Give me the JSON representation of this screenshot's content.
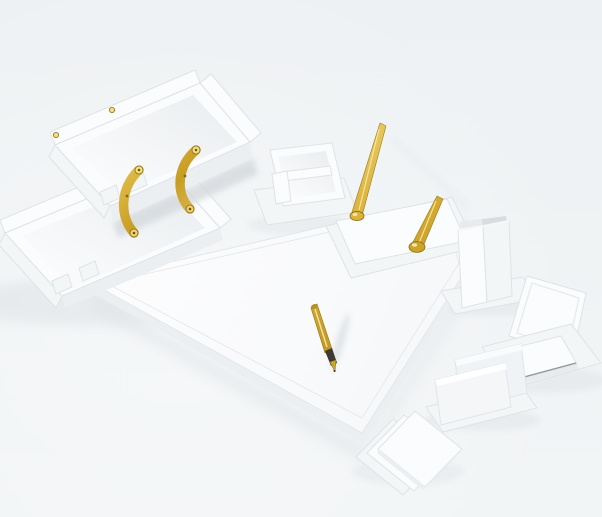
{
  "scene": {
    "type": "product-photograph",
    "subject": "White leather desk organizer set with gold accents arranged on a pale grey-blue studio background",
    "background": "soft light grey-blue studio sweep, brighter toward lower left",
    "palette": {
      "bg_top": "#edf1f3",
      "bg_bottom": "#f2f5f6",
      "white": "#fbfcfd",
      "white_dim": "#f3f6f7",
      "white_shadow": "#eceff1",
      "edge": "#dfe3e6",
      "interior": "#e9edef",
      "gap_shadow": "#d4d9dd",
      "shadow_tint": "#c7ced4",
      "cup_inner": "#d8dcdf",
      "gold_light": "#f3df87",
      "gold": "#d9ad31",
      "gold_dark": "#a87f16",
      "gold_strap_1": "#eccd5e",
      "gold_strap_2": "#c89d22",
      "gold_strap_3": "#ecd27a",
      "pen_grip": "#3d3933"
    },
    "objects": [
      {
        "name": "two-tier-document-tray",
        "description": "two stacked white letter trays joined by curved gold risers with screw fittings",
        "accent": "gold risers and screws"
      },
      {
        "name": "desk-pad",
        "description": "large white leather desk blotter with stitched inner border, rotated diagonally",
        "accent": "none"
      },
      {
        "name": "gold-fountain-pen",
        "description": "gold fountain pen with dark grip and nib lying on the desk pad",
        "accent": "gold body, dark nib"
      },
      {
        "name": "memo-paper-box",
        "description": "small white two-compartment paper/clip box on a white base pad",
        "accent": "none"
      },
      {
        "name": "double-pen-stand",
        "description": "white pen stand base with two gold pens standing at angles in round gold sockets",
        "accent": "two gold pens"
      },
      {
        "name": "pen-cup",
        "description": "square white pen cup on a white base plate, open top showing grey interior",
        "accent": "none"
      },
      {
        "name": "memo-pad-stand",
        "description": "white memo pad holder with raised back lid and paper pad on its base",
        "accent": "none"
      },
      {
        "name": "letter-holder",
        "description": "white two-panel letter / business card holder on a base plate",
        "accent": "none"
      },
      {
        "name": "coaster-stack",
        "description": "three square white coasters fanned out diagonally",
        "accent": "none"
      }
    ]
  }
}
